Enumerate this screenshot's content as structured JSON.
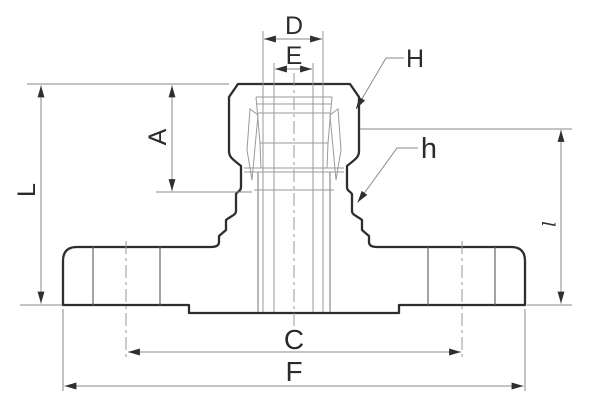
{
  "figure": {
    "type": "technical-drawing",
    "description": "Cross-section of a flanged cam-and-groove coupling adapter with dimension callouts",
    "background": "#ffffff",
    "colors": {
      "outline": "#2e2e2e",
      "internal_lines": "#9a9a9a",
      "dimension_lines": "#888888",
      "arrowheads": "#2f2f2f",
      "labels": "#2b2b2b"
    },
    "dimension_labels": {
      "top_outer_width": "D",
      "top_inner_width": "E",
      "upper_leader": "H",
      "socket_depth": "A",
      "overall_height": "L",
      "lower_leader": "h",
      "bolt_circle": "C",
      "flange_width": "F",
      "right_height": "l"
    }
  }
}
